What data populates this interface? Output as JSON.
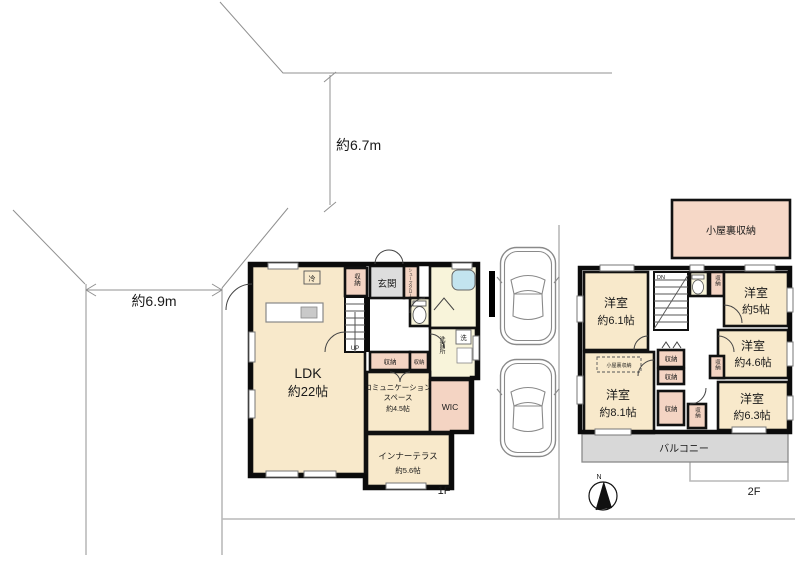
{
  "site": {
    "dim_top": "約6.7m",
    "dim_left": "約6.9m"
  },
  "floor1": {
    "label": "1F",
    "ldk": {
      "l1": "LDK",
      "l2": "約22帖"
    },
    "fridge": "冷",
    "storage_top": "収納",
    "up": "UP",
    "genkan": "玄関",
    "shoes_closet": "シューズクローク",
    "wash_mark": "洗",
    "washroom": "洗面所",
    "storage_a": "収納",
    "storage_b": "収納",
    "comm": {
      "l1": "コミュニケーション",
      "l2": "スペース",
      "l3": "約4.5帖"
    },
    "wic": "WIC",
    "terrace": {
      "l1": "インナーテラス",
      "l2": "約5.6帖"
    }
  },
  "floor2": {
    "label": "2F",
    "dn": "DN",
    "room61": {
      "l1": "洋室",
      "l2": "約6.1帖"
    },
    "room5": {
      "l1": "洋室",
      "l2": "約5帖"
    },
    "room46": {
      "l1": "洋室",
      "l2": "約4.6帖"
    },
    "room81": {
      "l1": "洋室",
      "l2": "約8.1帖"
    },
    "room63": {
      "l1": "洋室",
      "l2": "約6.3帖"
    },
    "attic_access": "小屋裏収納",
    "storage_top": "収納",
    "storage_mid": "収納",
    "st_a": "収納",
    "st_b": "収納",
    "st_c": "収納",
    "st_d": "収納",
    "balcony": "バルコニー"
  },
  "attic_box": {
    "label": "小屋裏収納"
  },
  "compass": {
    "north": "N"
  },
  "colors": {
    "room_cream": "#f8e9cb",
    "room_pink": "#f4d4c3",
    "wet_area_yellow": "#f8f4da",
    "entry_gray": "#dddddd",
    "balcony_gray": "#d8d8d8",
    "bathtub_blue": "#c3e4ef",
    "wall_black": "#0b0b0b",
    "boundary_gray": "#909090"
  }
}
